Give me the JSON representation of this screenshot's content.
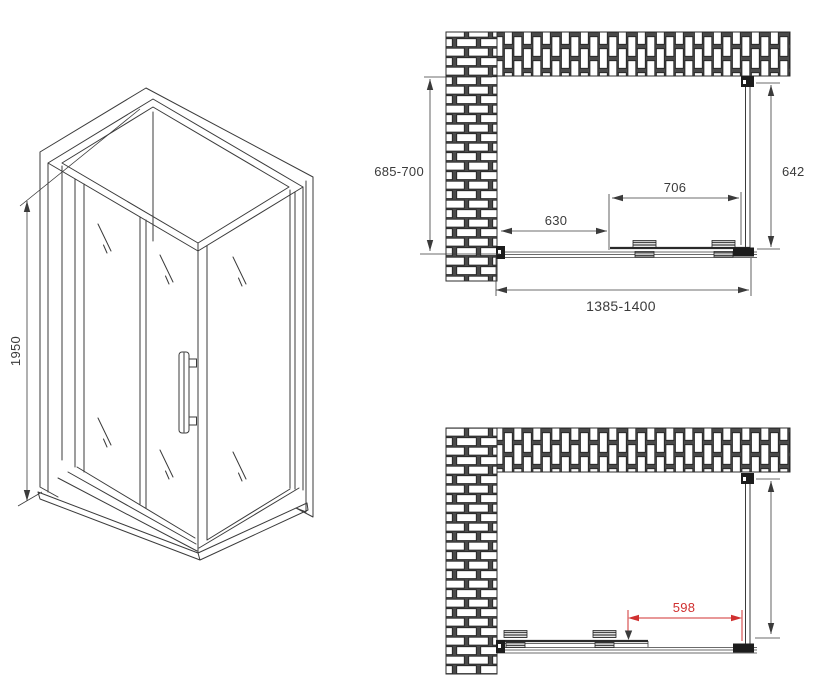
{
  "colors": {
    "background": "#ffffff",
    "line": "#3b3b3b",
    "dimension_red": "#d03030"
  },
  "iso_view": {
    "height_label": "1950"
  },
  "top_view": {
    "depth_label": "685-700",
    "glass_label": "642",
    "door_label": "706",
    "segment_label": "630",
    "width_label": "1385-1400"
  },
  "bottom_view": {
    "opening_label": "598"
  }
}
